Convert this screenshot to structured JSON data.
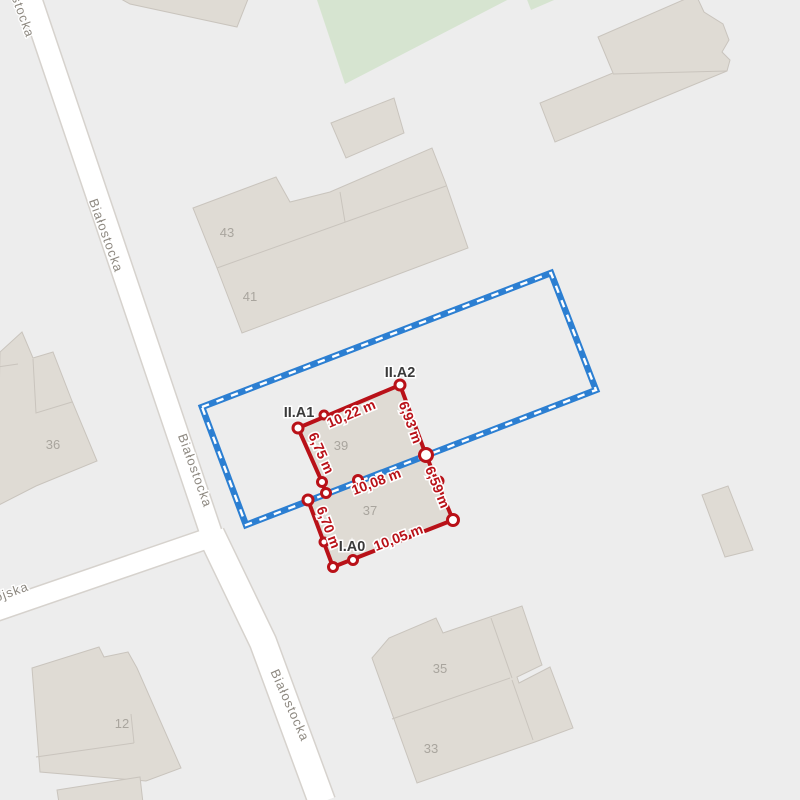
{
  "map": {
    "colors": {
      "background": "#ededed",
      "street_fill": "#ffffff",
      "street_casing": "#d6d2cd",
      "building_fill": "#dfdbd4",
      "building_stroke": "#c9c4bd",
      "green_area": "#d6e4d0",
      "boundary_blue": "#2c7fd2",
      "survey_red": "#b91118",
      "parcel_label_color": "#3a3a3a",
      "building_number_color": "#a9a59e",
      "street_label_color": "#8d8880"
    },
    "street_labels": [
      {
        "text": "stocka"
      },
      {
        "text": "Białostocka"
      },
      {
        "text": "Białostocka"
      },
      {
        "text": "Białostocka"
      },
      {
        "text": "ojska"
      }
    ],
    "building_numbers": [
      {
        "text": "43"
      },
      {
        "text": "41"
      },
      {
        "text": "39"
      },
      {
        "text": "37"
      },
      {
        "text": "36"
      },
      {
        "text": "35"
      },
      {
        "text": "33"
      },
      {
        "text": "12"
      }
    ],
    "survey": {
      "point_labels": [
        {
          "text": "II.A1"
        },
        {
          "text": "II.A2"
        },
        {
          "text": "I.A0"
        }
      ],
      "measurements": [
        {
          "text": "10,22 m"
        },
        {
          "text": "6,93 m"
        },
        {
          "text": "6,75 m"
        },
        {
          "text": "10,08 m"
        },
        {
          "text": "6,59 m"
        },
        {
          "text": "6,70 m"
        },
        {
          "text": "10,05 m"
        }
      ]
    }
  }
}
